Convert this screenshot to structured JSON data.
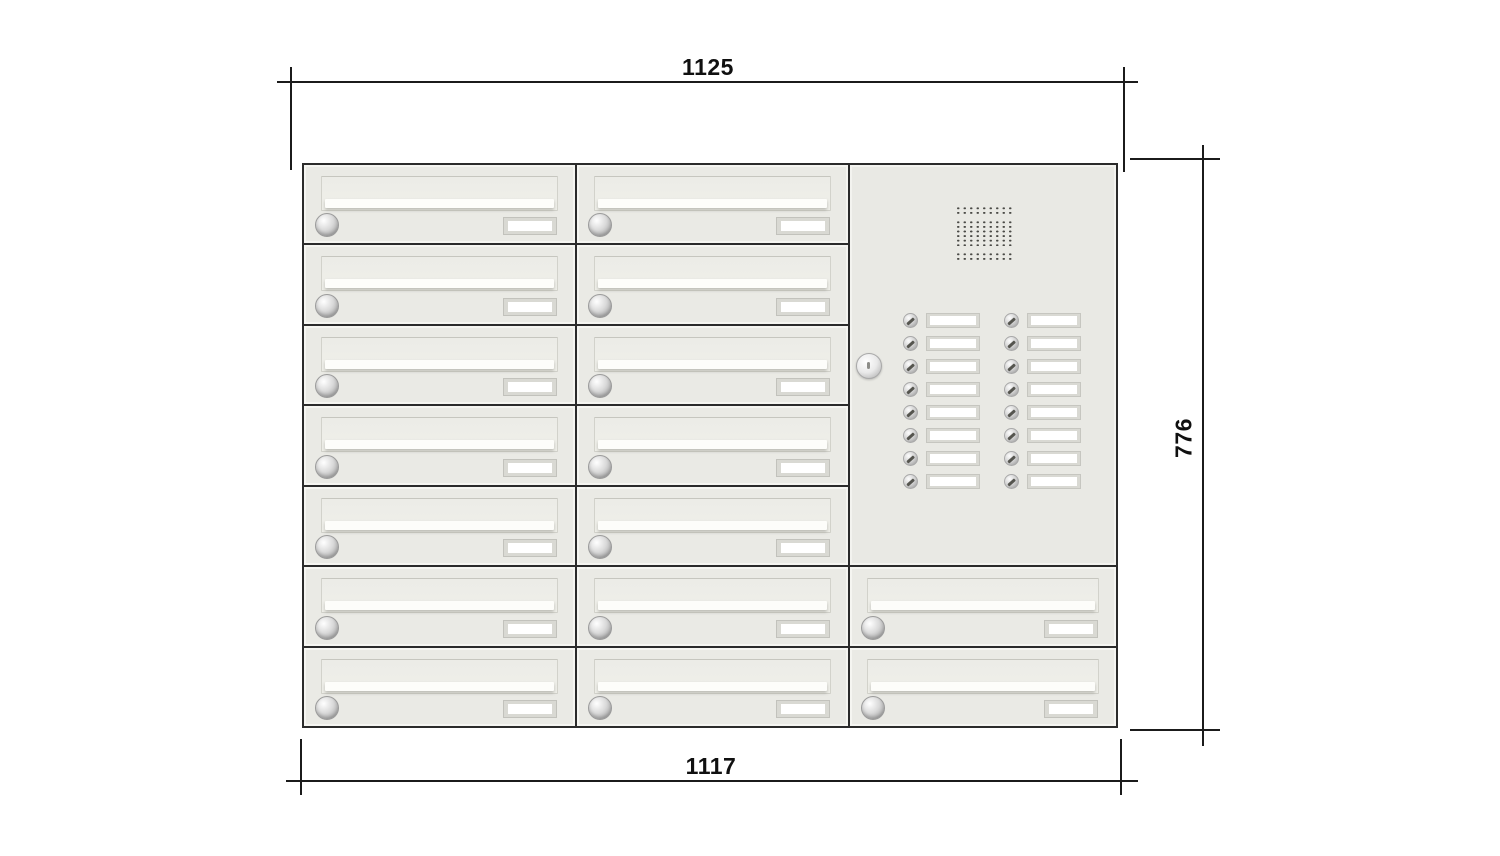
{
  "drawing": {
    "type": "technical-dimension-drawing",
    "subject": "wall letterbox bank with intercom panel",
    "dimensions": {
      "top": {
        "label": "1125",
        "orientation": "horizontal"
      },
      "right": {
        "label": "776",
        "orientation": "vertical"
      },
      "bottom": {
        "label": "1117",
        "orientation": "horizontal"
      }
    }
  },
  "cabinet": {
    "columns": 3,
    "rows": 7,
    "mailbox_count": 16,
    "mailboxes": [
      {
        "col": 1,
        "row": 1
      },
      {
        "col": 1,
        "row": 2
      },
      {
        "col": 1,
        "row": 3
      },
      {
        "col": 1,
        "row": 4
      },
      {
        "col": 1,
        "row": 5
      },
      {
        "col": 1,
        "row": 6
      },
      {
        "col": 1,
        "row": 7
      },
      {
        "col": 2,
        "row": 1
      },
      {
        "col": 2,
        "row": 2
      },
      {
        "col": 2,
        "row": 3
      },
      {
        "col": 2,
        "row": 4
      },
      {
        "col": 2,
        "row": 5
      },
      {
        "col": 2,
        "row": 6
      },
      {
        "col": 2,
        "row": 7
      },
      {
        "col": 3,
        "row": 6
      },
      {
        "col": 3,
        "row": 7
      }
    ],
    "mailbox_features": [
      "mail-slot-flap",
      "cylinder-lock",
      "blank-name-plate"
    ],
    "intercom": {
      "panel_rows_spanned": 5,
      "speaker_grille": true,
      "panel_lock": true,
      "bell_rows": 8,
      "bell_columns": 2,
      "bell_button_count": 16,
      "bell_name_plates_blank": true
    }
  },
  "colors": {
    "background": "#ffffff",
    "cabinet_body": "#eaeae5",
    "panel_body": "#e9e9e4",
    "grid_line": "#2b2b2b",
    "dimension_line": "#1b1b1b",
    "plate_frame": "#d9d9d3",
    "plate_inner": "#ffffff",
    "grille_dot": "#4a4a46"
  }
}
